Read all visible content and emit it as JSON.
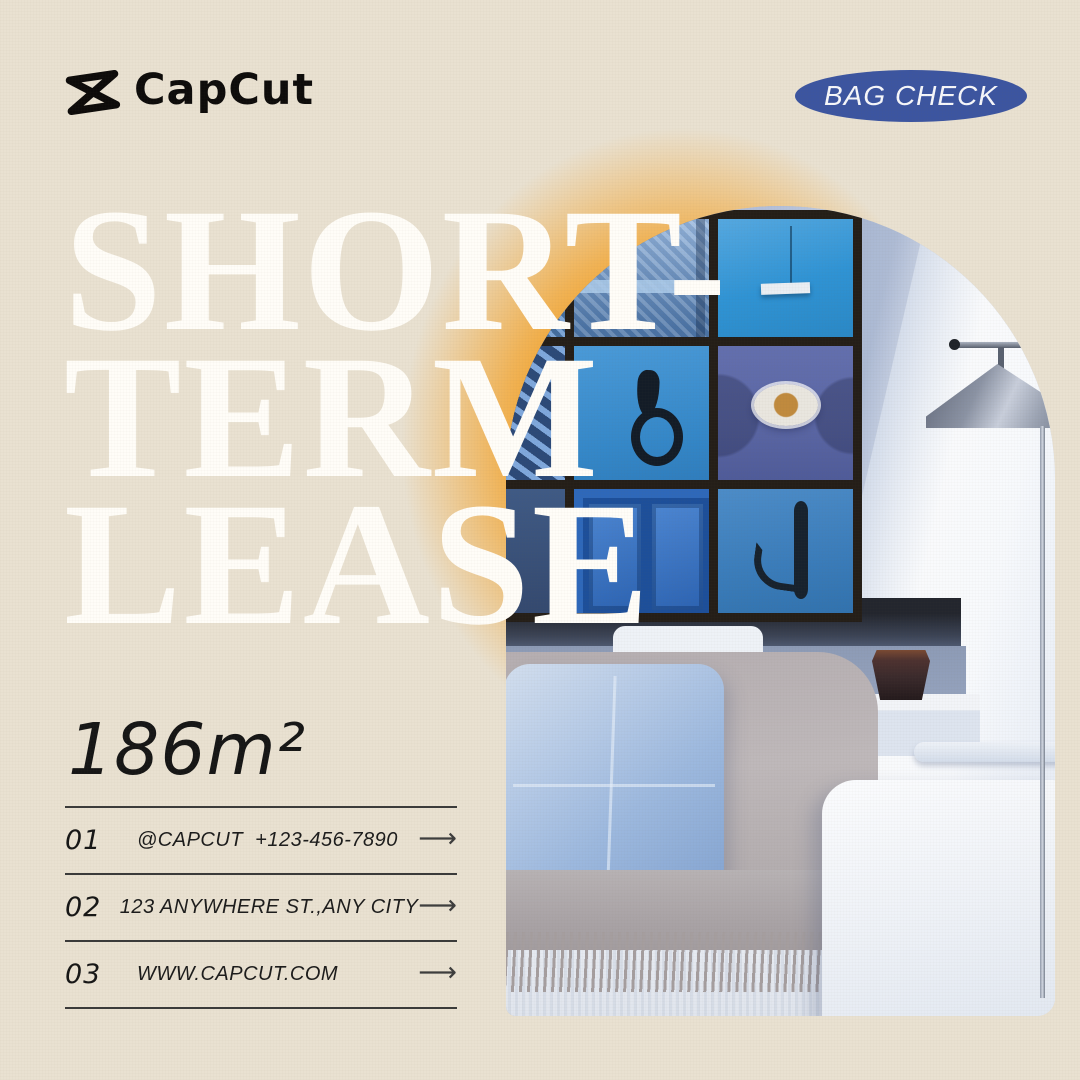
{
  "header": {
    "brand": "CapCut",
    "badge": "BAG CHECK"
  },
  "title": {
    "lines": [
      "SHORT-",
      "TERM",
      "LEASE"
    ]
  },
  "area": {
    "value": "186m²"
  },
  "contacts": [
    {
      "num": "01",
      "text": "@CAPCUT  +123-456-7890"
    },
    {
      "num": "02",
      "text": "123 ANYWHERE ST.,ANY CITY"
    },
    {
      "num": "03",
      "text": "WWW.CAPCUT.COM"
    }
  ],
  "icons": {
    "arrow": "⟶"
  },
  "photo": {
    "description": "arched photo of living room: wall collage of nine blue doors, floor lamp, couch with blue pillow and fringed grey throw"
  },
  "colors": {
    "background": "#e9e1d1",
    "badge_blue": "#3c55a0",
    "glow_orange": "#f3a42e",
    "headline_white": "#fffdf8",
    "ink": "#161616",
    "rule": "#3a3a3a"
  }
}
